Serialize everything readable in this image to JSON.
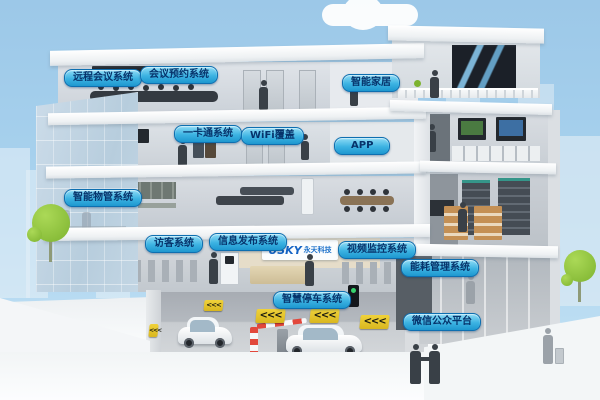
{
  "labels": [
    {
      "id": "remote-conference-system",
      "text": "远程会议系统"
    },
    {
      "id": "meeting-reservation-system",
      "text": "会议预约系统"
    },
    {
      "id": "smart-home",
      "text": "智能家居"
    },
    {
      "id": "one-card-system",
      "text": "一卡通系统"
    },
    {
      "id": "wifi-coverage",
      "text": "WiFi覆盖"
    },
    {
      "id": "app",
      "text": "APP"
    },
    {
      "id": "property-management-system",
      "text": "智能物管系统"
    },
    {
      "id": "visitor-system",
      "text": "访客系统"
    },
    {
      "id": "info-publishing-system",
      "text": "信息发布系统"
    },
    {
      "id": "video-surveillance-system",
      "text": "视频监控系统"
    },
    {
      "id": "energy-management-system",
      "text": "能耗管理系统"
    },
    {
      "id": "smart-parking-system",
      "text": "智慧停车系统"
    },
    {
      "id": "wechat-public-platform",
      "text": "微信公众平台"
    }
  ],
  "logo": {
    "name": "USKY",
    "suffix": "永天科技"
  },
  "parking": {
    "arrow_glyph": "<<<"
  },
  "colors": {
    "sky": "#9cc8e8",
    "label_background_top": "#8fdcf6",
    "label_background_bottom": "#1e97cf",
    "label_border": "#0e6fb0",
    "label_text": "#06336b",
    "logo_blue": "#1463c4",
    "tree_green": "#8dc63f",
    "arrow_sign_yellow": "#e4c42c"
  }
}
